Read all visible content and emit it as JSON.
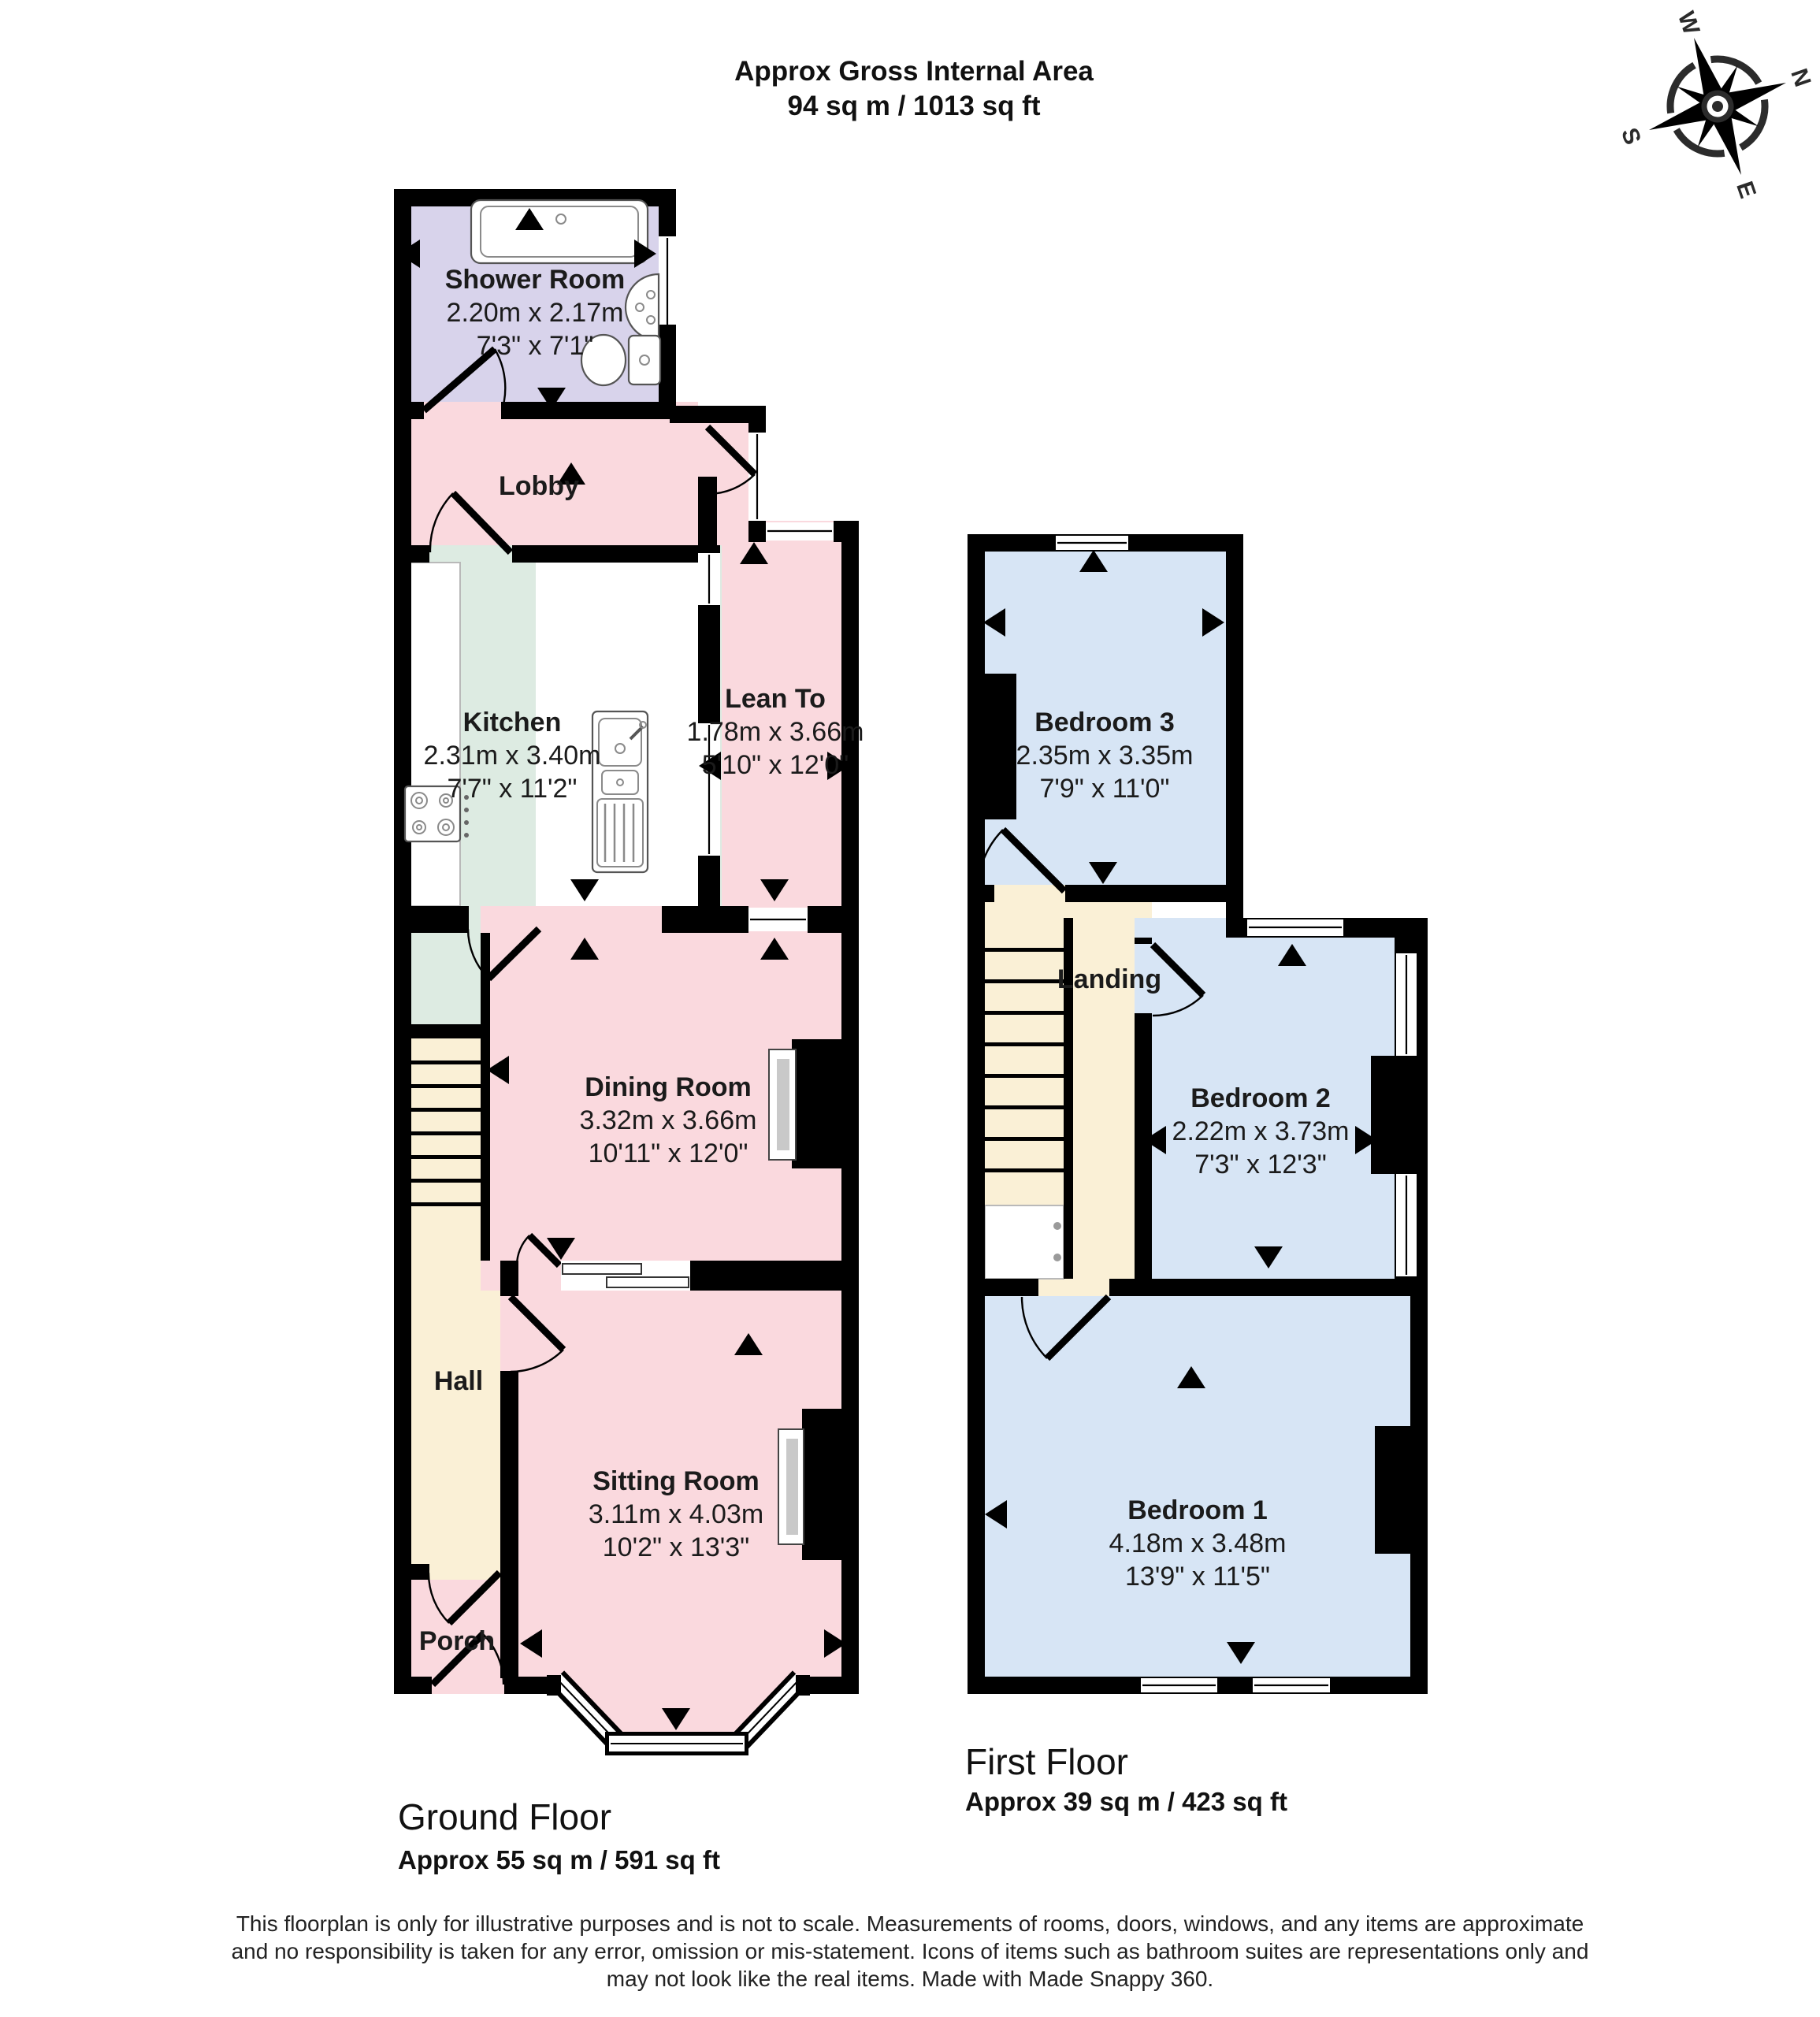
{
  "header": {
    "title": "Approx Gross Internal Area",
    "subtitle": "94 sq m / 1013 sq ft"
  },
  "compass": {
    "north": "N",
    "east": "E",
    "south": "S",
    "west": "W"
  },
  "ground_floor": {
    "label": "Ground Floor",
    "area": "Approx 55 sq m / 591 sq ft",
    "rooms": {
      "shower": {
        "name": "Shower Room",
        "metric": "2.20m x 2.17m",
        "imperial": "7'3\" x 7'1\""
      },
      "lobby": {
        "name": "Lobby"
      },
      "kitchen": {
        "name": "Kitchen",
        "metric": "2.31m x 3.40m",
        "imperial": "7'7\" x 11'2\""
      },
      "lean_to": {
        "name": "Lean To",
        "metric": "1.78m x 3.66m",
        "imperial": "5'10\" x 12'0\""
      },
      "dining": {
        "name": "Dining Room",
        "metric": "3.32m x 3.66m",
        "imperial": "10'11\" x 12'0\""
      },
      "hall": {
        "name": "Hall"
      },
      "sitting": {
        "name": "Sitting Room",
        "metric": "3.11m x 4.03m",
        "imperial": "10'2\" x 13'3\""
      },
      "porch": {
        "name": "Porch"
      }
    }
  },
  "first_floor": {
    "label": "First Floor",
    "area": "Approx 39 sq m / 423 sq ft",
    "rooms": {
      "bedroom3": {
        "name": "Bedroom 3",
        "metric": "2.35m x 3.35m",
        "imperial": "7'9\" x 11'0\""
      },
      "landing": {
        "name": "Landing"
      },
      "bedroom2": {
        "name": "Bedroom 2",
        "metric": "2.22m x 3.73m",
        "imperial": "7'3\" x 12'3\""
      },
      "bedroom1": {
        "name": "Bedroom 1",
        "metric": "4.18m x 3.48m",
        "imperial": "13'9\" x 11'5\""
      }
    }
  },
  "footer": {
    "line1": "This floorplan is only for illustrative purposes and is not to scale. Measurements of rooms, doors, windows, and any items are approximate",
    "line2": "and no responsibility is taken for any error, omission or mis-statement. Icons of items such as bathroom suites are representations only and",
    "line3": "may not look like the real items. Made with Made Snappy 360."
  },
  "colors": {
    "wall": "#000000",
    "shower_room": "#d8d3eb",
    "pink_rooms": "#fad9de",
    "kitchen": "#ddebe2",
    "hall_stairs": "#faf0d6",
    "bedrooms": "#d7e5f5",
    "text": "#1b1b1b"
  }
}
